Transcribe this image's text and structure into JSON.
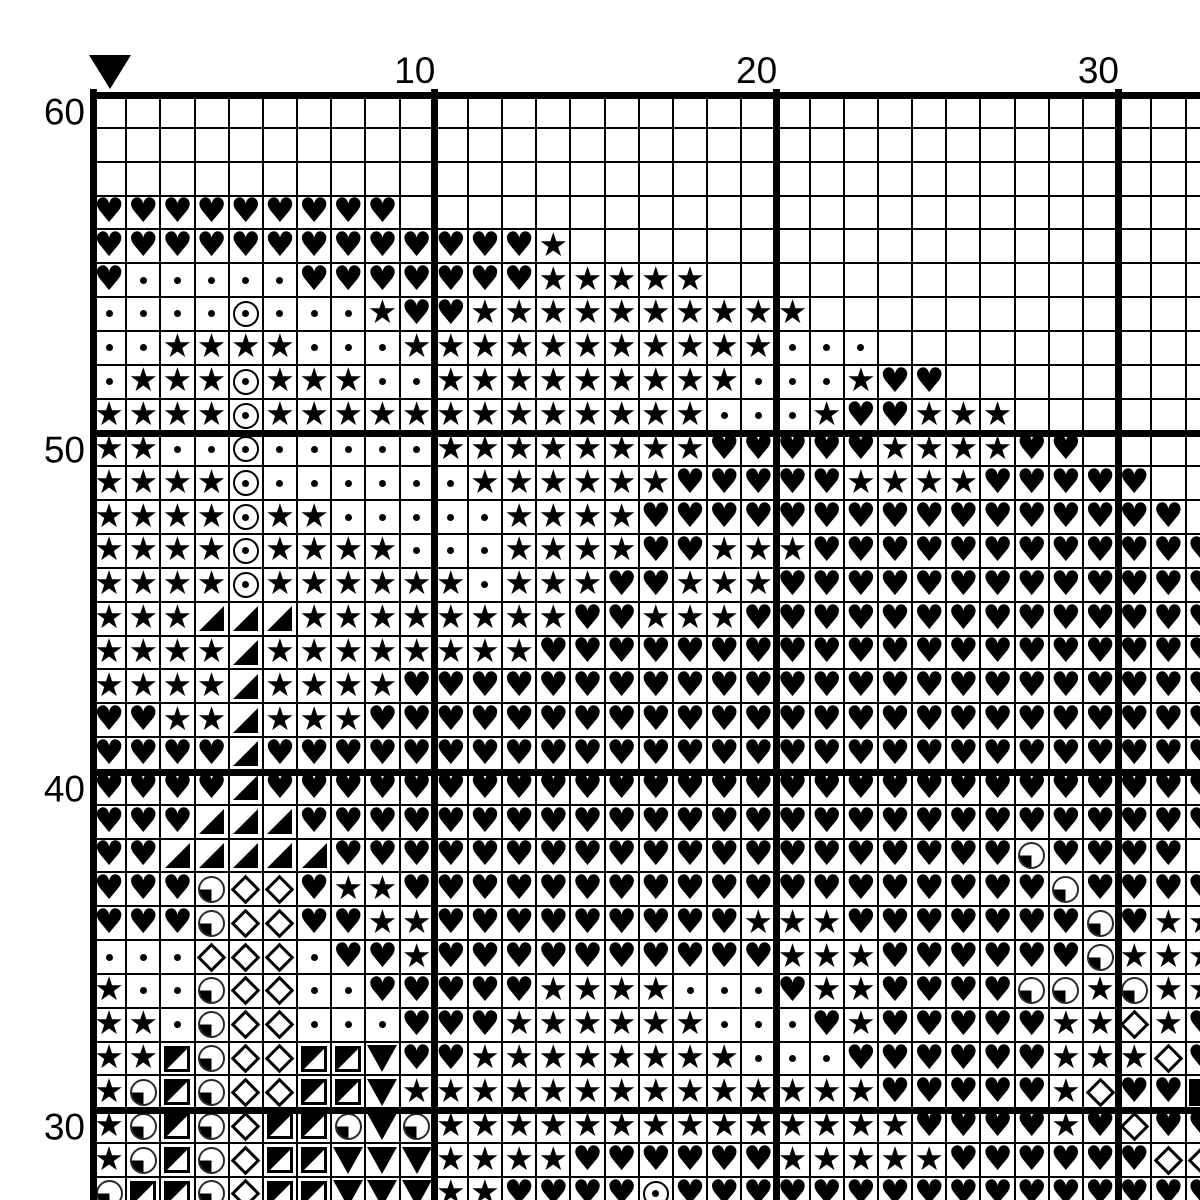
{
  "chart_type": "cross-stitch-pattern-grid",
  "colors": {
    "ink": "#000000",
    "background": "#ffffff"
  },
  "axes": {
    "top_labels": [
      {
        "text": "10",
        "col": 10
      },
      {
        "text": "20",
        "col": 20
      },
      {
        "text": "30",
        "col": 30
      }
    ],
    "left_labels": [
      {
        "text": "60",
        "row": 60
      },
      {
        "text": "50",
        "row": 50
      },
      {
        "text": "40",
        "row": 40
      },
      {
        "text": "30",
        "row": 30
      }
    ],
    "center_marker": {
      "shape": "down-triangle-icon",
      "col": 1
    }
  },
  "legend": {
    ".": "empty",
    "h": "heart",
    "s": "star",
    "d": "dot",
    "o": "circled-dot",
    "m": "diamond",
    "t": "lower-right-triangle",
    "q": "quarter-circle",
    "n": "half-square",
    "v": "down-triangle",
    "b": "black-square"
  },
  "grid": {
    "start_row": 60,
    "visible_cols": 33,
    "bold_every": 10,
    "rows": [
      {
        "row": 60,
        "cells": "................................."
      },
      {
        "row": 59,
        "cells": "................................."
      },
      {
        "row": 58,
        "cells": "................................."
      },
      {
        "row": 57,
        "cells": "hhhhhhhhh........................"
      },
      {
        "row": 56,
        "cells": "hhhhhhhhhhhhhs..................."
      },
      {
        "row": 55,
        "cells": "hdddddhhhhhhhsssss..............."
      },
      {
        "row": 54,
        "cells": "ddddodddshhssssssssss............"
      },
      {
        "row": 53,
        "cells": "ddssssdddsssssssssssddd.........."
      },
      {
        "row": 52,
        "cells": "dsssosssddsssssssssdddshh........"
      },
      {
        "row": 51,
        "cells": "ssssosssssssssssssdddshhsss......"
      },
      {
        "row": 50,
        "cells": "ssddodddddsssssssshhhhhsssshh...."
      },
      {
        "row": 49,
        "cells": "ssssoddddddsssssshhhhhsssshhhhh.."
      },
      {
        "row": 48,
        "cells": "ssssossdddddsssshhhhhhhhhhhhhhhh."
      },
      {
        "row": 47,
        "cells": "ssssossssdddsssshhssshhhhhhhhhhhh"
      },
      {
        "row": 46,
        "cells": "ssssosssssSdssshhssshhhhhhhhhhhhh"
      },
      {
        "row": 45,
        "cells": "ssstttsssssssshhssshhhhhhhhhhhhhh"
      },
      {
        "row": 44,
        "cells": "sssstsssssssshhhhhhhhhhhhhhhhhhhh"
      },
      {
        "row": 43,
        "cells": "sssstsssshhhhhhhhhhhhhhhhhhhhhhhh"
      },
      {
        "row": 42,
        "cells": "hhsstssshhhhhhhhhhhhhhhhhhhhhhhhh"
      },
      {
        "row": 41,
        "cells": "hhhhthhhhhhhhhhhhhhhhhhhhhhhhhhhh"
      },
      {
        "row": 40,
        "cells": "hhhhthhhhhhhhhhhhhhhhhhhhhhhhhhhh"
      },
      {
        "row": 39,
        "cells": "hhhttthhhhhhhhhhhhhhhhhhhhhhhhhhh"
      },
      {
        "row": 38,
        "cells": "hhttttthhhhhhhhhhhhhhhhhhhhqhhhh"
      },
      {
        "row": 37,
        "cells": "hhhqmmhsshhhhhhhhhhhhhhhhhhhqhhhh"
      },
      {
        "row": 36,
        "cells": "hhhqmmhhsshhhhhhhhhssshhhhhhhqhss"
      },
      {
        "row": 35,
        "cells": "dddmmmdhhshhhhhhhhhhssshhhhhhqsss"
      },
      {
        "row": 34,
        "cells": "sddqmmddhhhhhssssdddhsshhhhqqsqss"
      },
      {
        "row": 33,
        "cells": "ssdqmmdddhhhssssssdddhshhhhhssmsh"
      },
      {
        "row": 32,
        "cells": "ssnqmmnnvhhssssssssdddhhhhhhsssmh"
      },
      {
        "row": 31,
        "cells": "sqnqmmnnvsssssssssssssshhhhhsmhhb"
      },
      {
        "row": 30,
        "cells": "sqnqmnnqvqsssssssssssssshhhhshmhh"
      },
      {
        "row": 29,
        "cells": "sqnqmnnvvvsssshhhhhhssssshhhhhhmm"
      },
      {
        "row": 28,
        "cells": "qnnqmnnvvvsshhhhohhhhhhhhhhhhhhhh"
      }
    ]
  }
}
